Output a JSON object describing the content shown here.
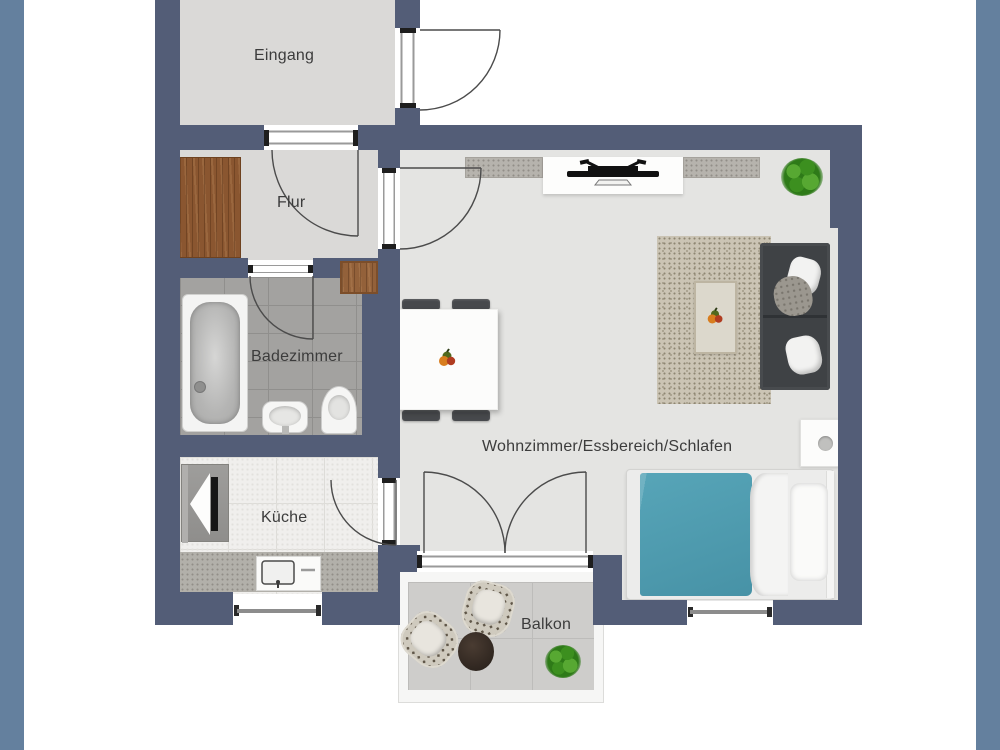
{
  "meta": {
    "type": "floor-plan",
    "language": "de"
  },
  "palette": {
    "frame_bar": "#64809e",
    "wall": "#535d77",
    "floor_living": "#e4e4e2",
    "floor_entry": "#dad9d7",
    "floor_bath": "#a3a2a0",
    "floor_kitchen": "#f0efed",
    "floor_balcony": "#cecdcb",
    "counter": "#b2b0aa",
    "wood": "#8a5630",
    "sofa": "#3f4245",
    "bed_blanket": "#4f9cb0",
    "rug": "#cbc4b4",
    "plant": "#2e7a18",
    "label_text": "#3c3c3c"
  },
  "rooms": {
    "eingang": {
      "label": "Eingang"
    },
    "flur": {
      "label": "Flur"
    },
    "badezimmer": {
      "label": "Badezimmer"
    },
    "kueche": {
      "label": "Küche"
    },
    "wohnbereich": {
      "label": "Wohnzimmer/Essbereich/Schlafen"
    },
    "balkon": {
      "label": "Balkon"
    }
  }
}
